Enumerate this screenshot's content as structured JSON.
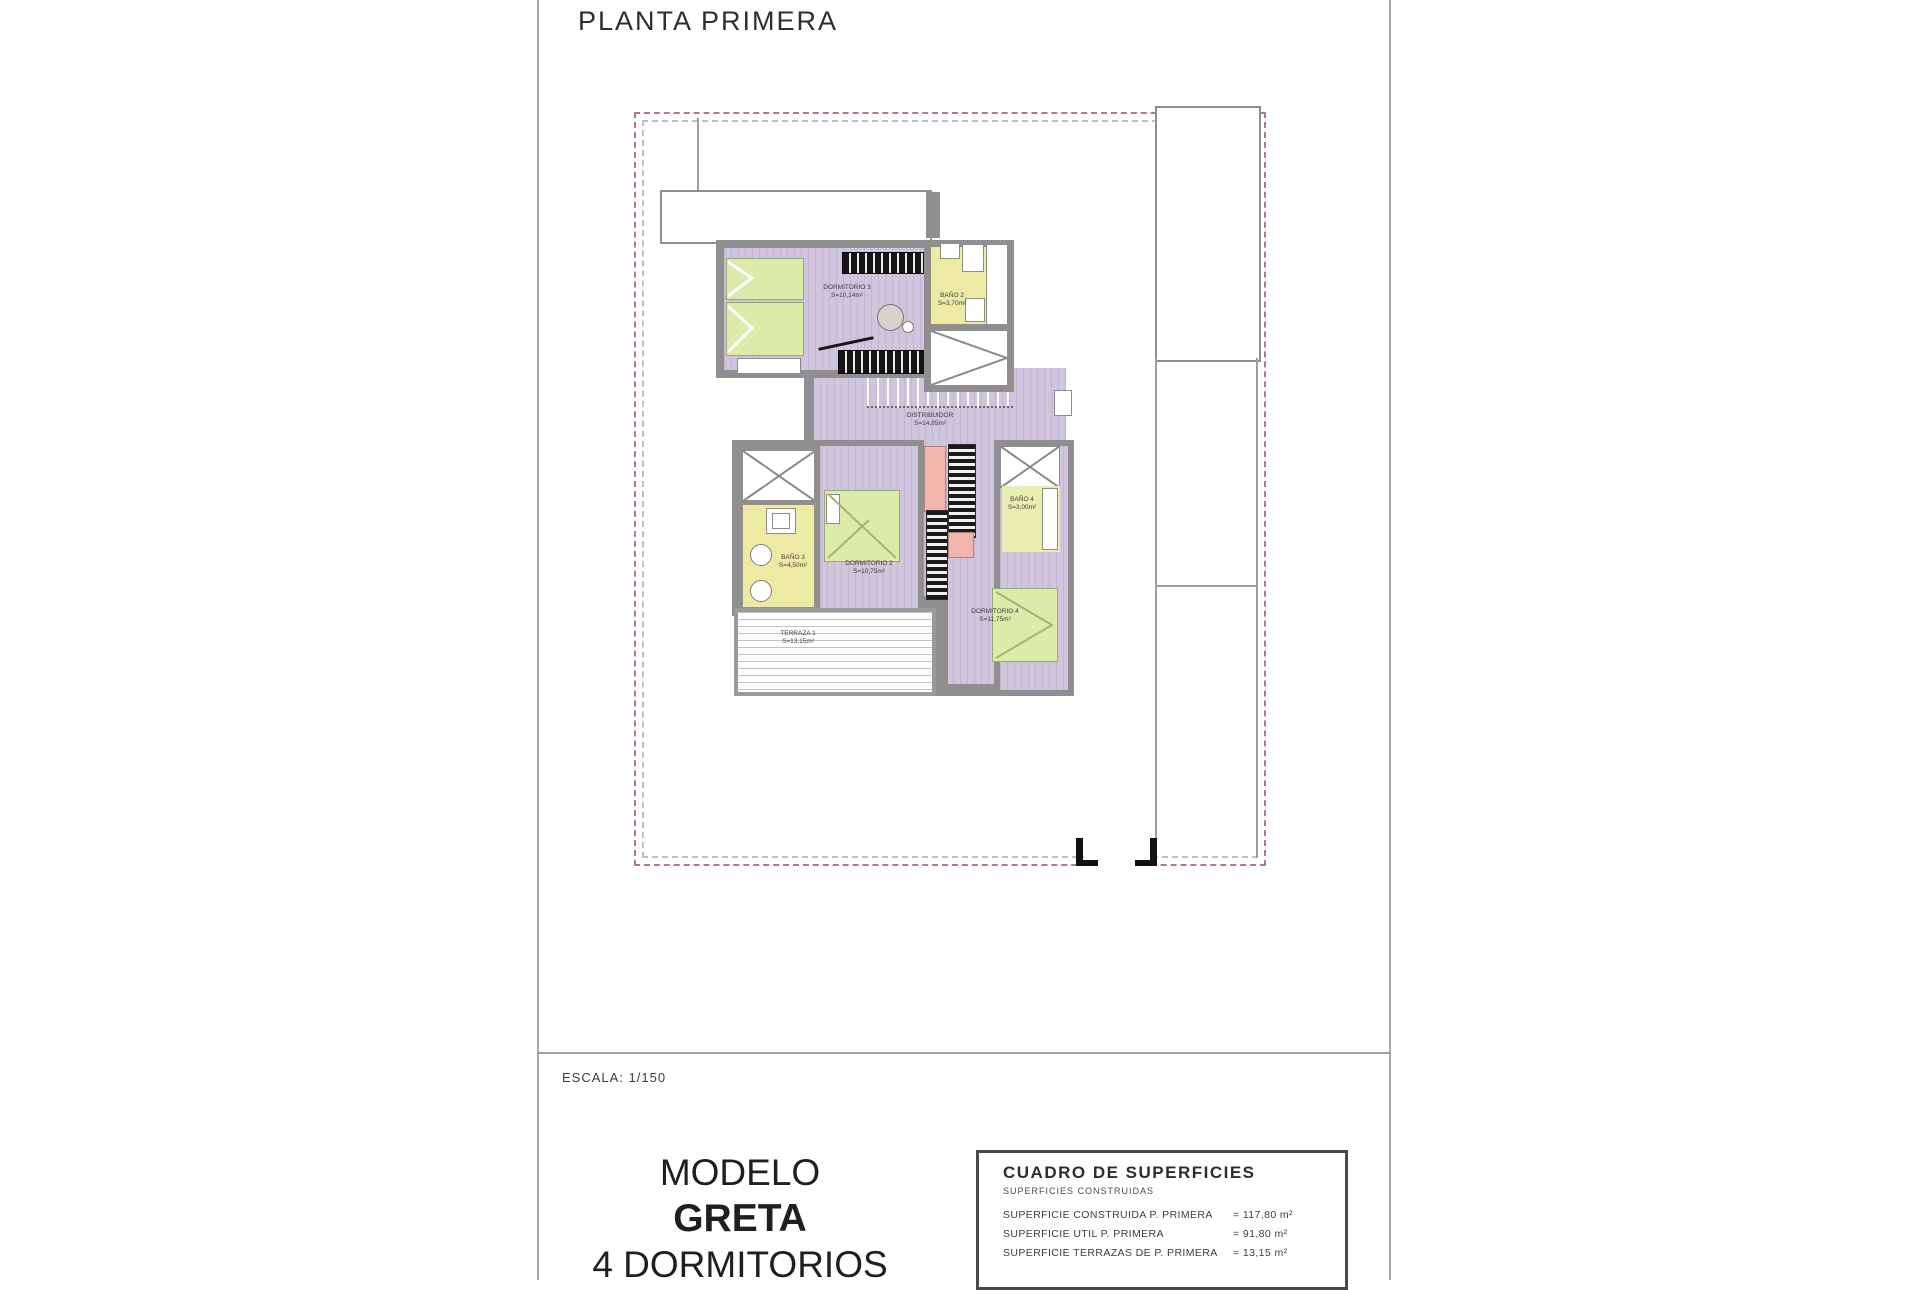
{
  "title": "PLANTA PRIMERA",
  "scale_label": "ESCALA: 1/150",
  "model_block": {
    "line1": "MODELO",
    "line2": "GRETA",
    "line3": "4 DORMITORIOS"
  },
  "surfaces_table": {
    "title": "CUADRO DE SUPERFICIES",
    "subtitle": "SUPERFICIES CONSTRUIDAS",
    "rows": [
      {
        "label": "SUPERFICIE CONSTRUIDA P. PRIMERA",
        "value": "= 117,80 m²"
      },
      {
        "label": "SUPERFICIE UTIL P. PRIMERA",
        "value": "= 91,80 m²"
      },
      {
        "label": "SUPERFICIE TERRAZAS DE P. PRIMERA",
        "value": "= 13,15 m²"
      }
    ]
  },
  "plan": {
    "rooms": [
      {
        "id": "dormitorio-3",
        "label": "DORMITORIO 3",
        "area": "S=10,14m²"
      },
      {
        "id": "bano-2",
        "label": "BAÑO 2",
        "area": "S=3,70m²"
      },
      {
        "id": "distribuidor",
        "label": "DISTRIBUIDOR",
        "area": "S=14,85m²"
      },
      {
        "id": "bano-3",
        "label": "BAÑO 3",
        "area": "S=4,50m²"
      },
      {
        "id": "dormitorio-2",
        "label": "DORMITORIO 2",
        "area": "S=10,75m²"
      },
      {
        "id": "bano-4",
        "label": "BAÑO 4",
        "area": "S=3,00m²"
      },
      {
        "id": "dormitorio-4",
        "label": "DORMITORIO 4",
        "area": "S=11,75m²"
      },
      {
        "id": "terraza-1",
        "label": "TERRAZA 1",
        "area": "S=13,15m²"
      }
    ],
    "colors": {
      "floor_lavender": "#cfc6dd",
      "floor_bath_yellow": "#edeaa4",
      "furniture_green": "#dcebaa",
      "stairs_pink": "#f1b5ac",
      "wall_gray": "#8f8f8f",
      "boundary_dash_red": "#ad7e7e"
    }
  }
}
